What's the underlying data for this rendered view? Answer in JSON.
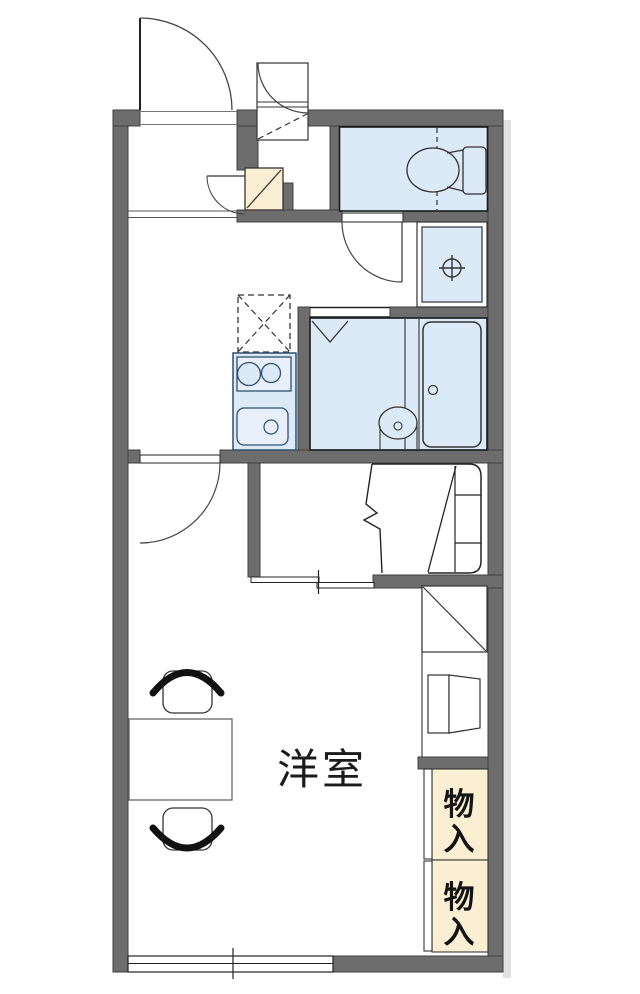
{
  "plan": {
    "type": "apartment-floor-plan",
    "rooms": {
      "main_label": "洋室",
      "storage": {
        "cells": [
          {
            "chars": [
              "物",
              "入"
            ]
          },
          {
            "chars": [
              "物",
              "入"
            ]
          }
        ]
      }
    },
    "fixtures": [
      "entrance-door",
      "outside-storage-door",
      "shoe-cabinet",
      "toilet",
      "washing-machine-pan",
      "washroom-door",
      "refrigerator-space",
      "kitchen-stove",
      "kitchen-sink",
      "bathroom-folding-door",
      "bathtub",
      "washbasin",
      "room-door",
      "bed",
      "sliding-door",
      "closet-shelf",
      "table",
      "chair",
      "chair",
      "sliding-window"
    ],
    "colors": {
      "wall": "#6d6d6d",
      "wall_outline": "#3f3f3f",
      "room_blue": "#dce9f7",
      "fixture_blue_light": "#e6effa",
      "storage_beige": "#faeed3",
      "line_dark": "#1f1f1f",
      "kitchen_line": "#2f4f6f",
      "shadow": "#c9c9c9",
      "text": "#111111"
    }
  }
}
